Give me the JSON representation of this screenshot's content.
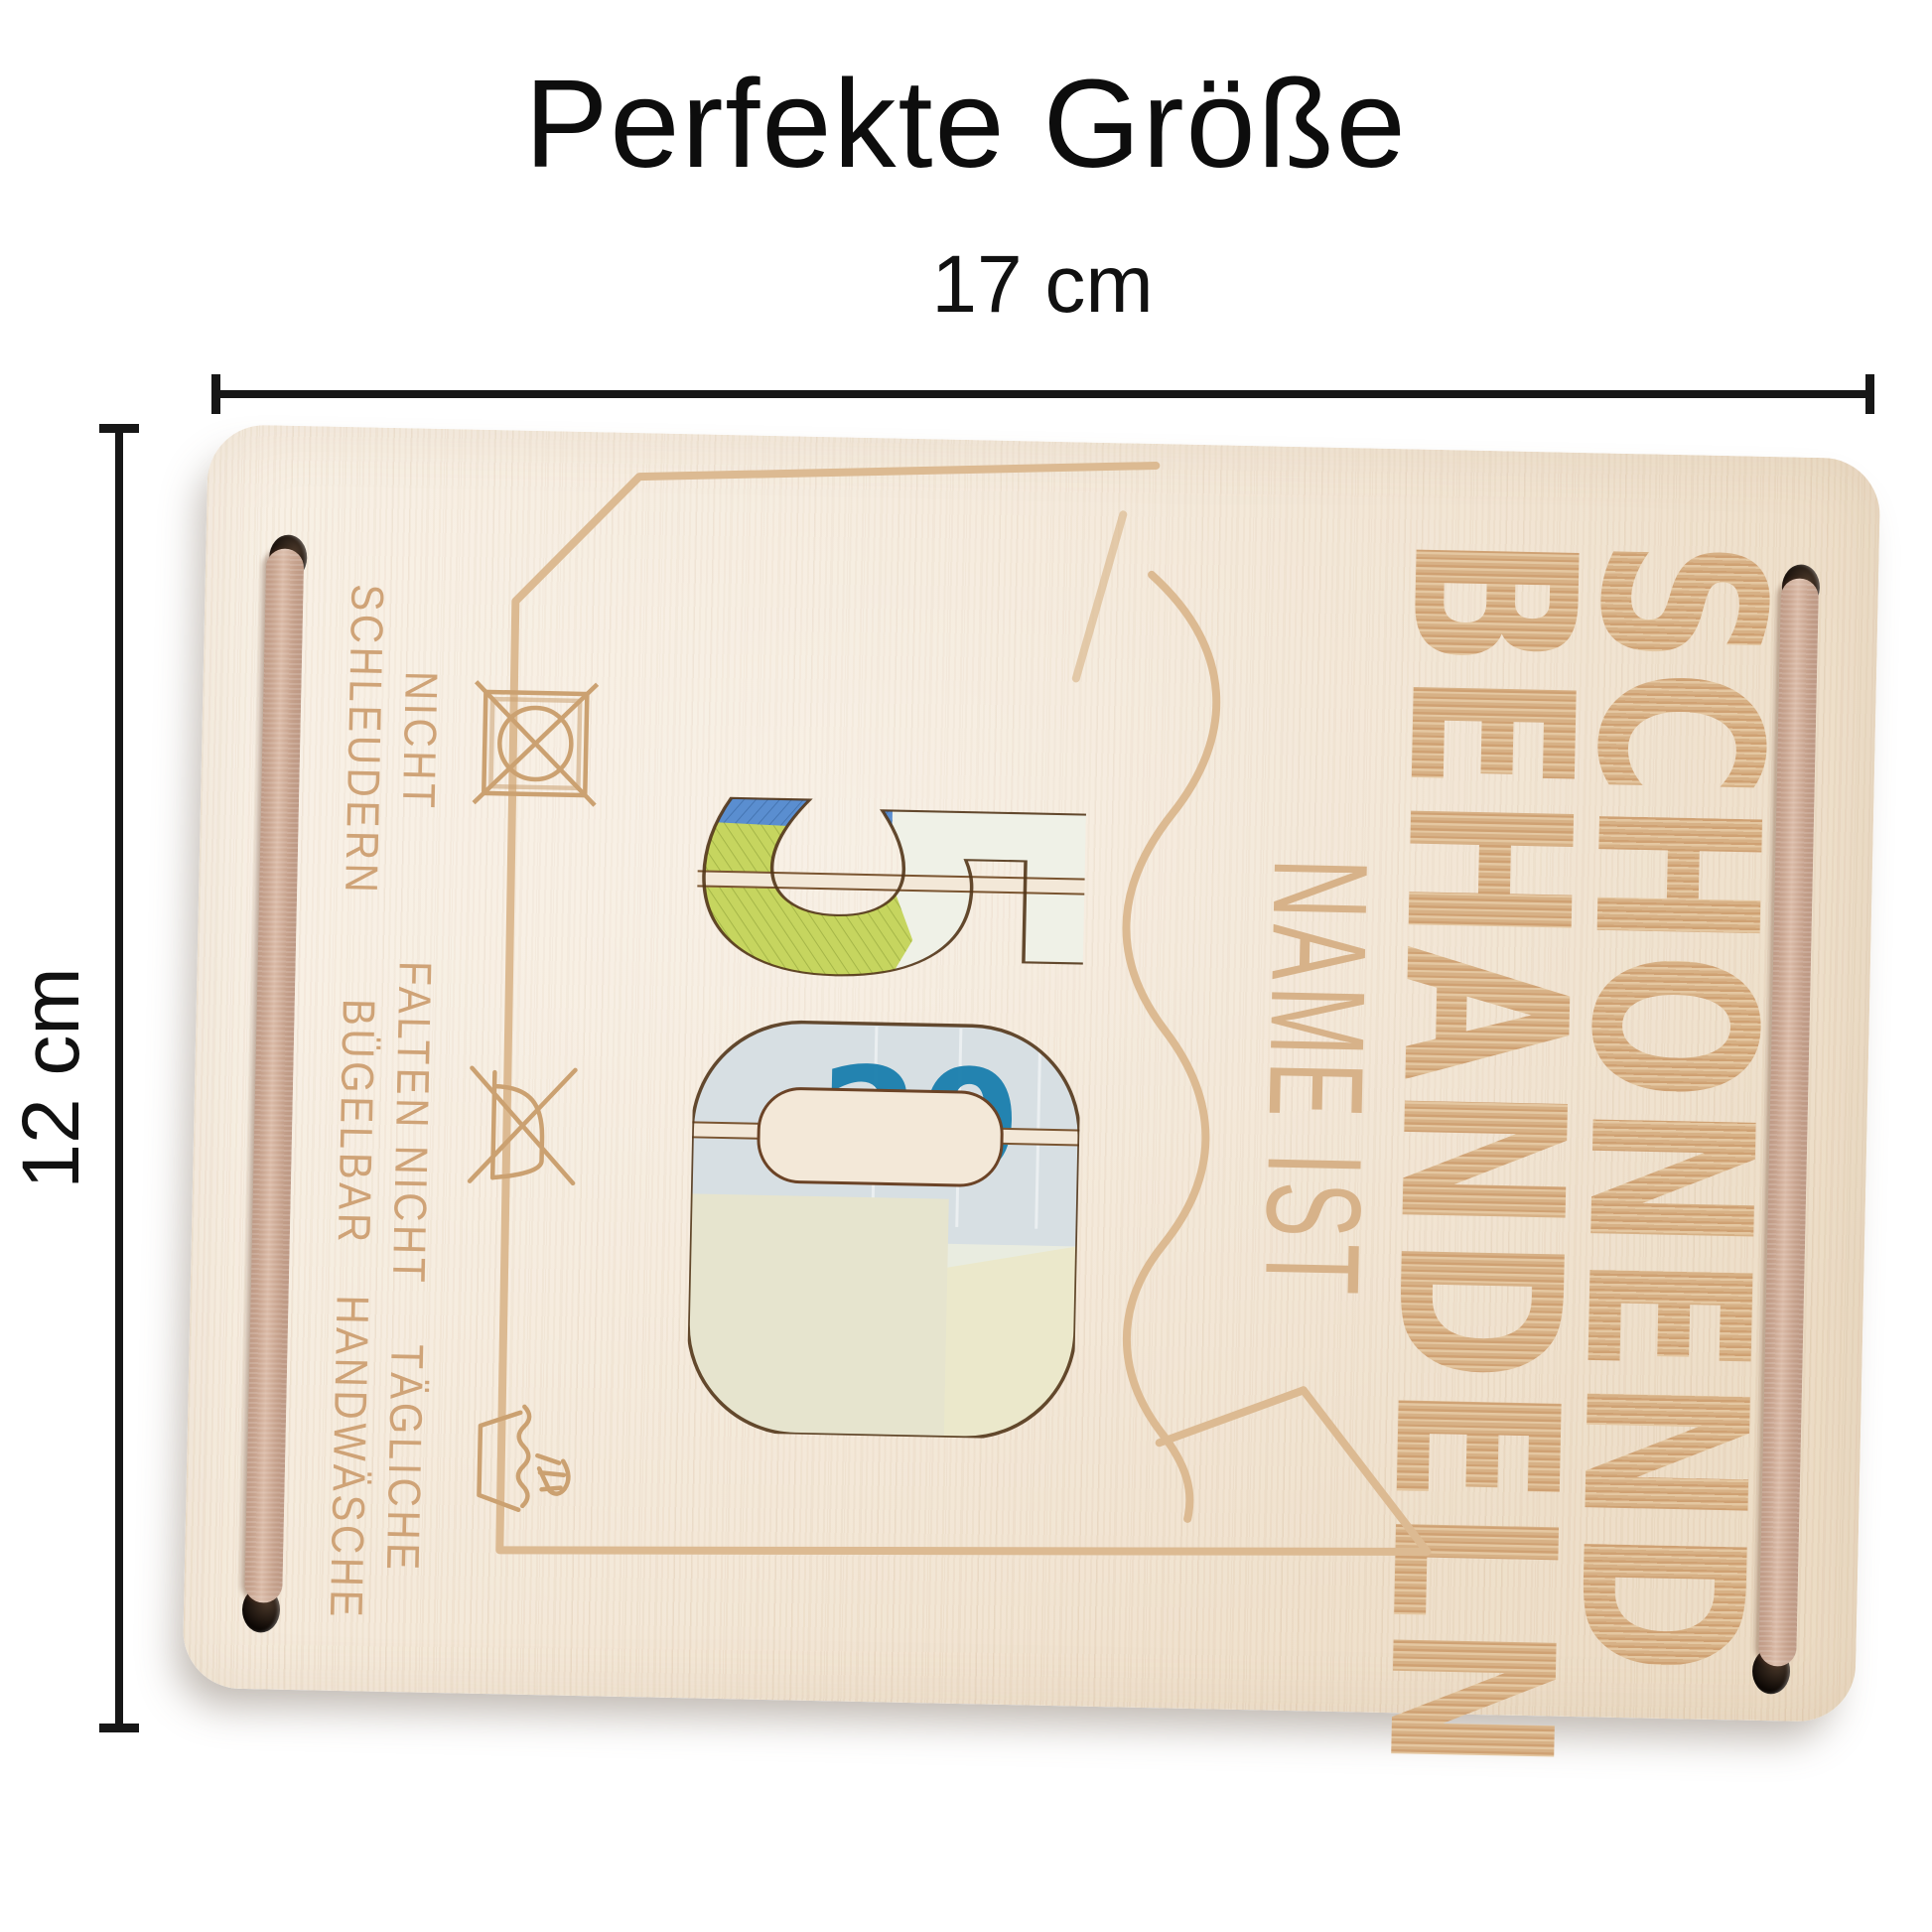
{
  "title": "Perfekte Größe",
  "dimensions": {
    "width_label": "17 cm",
    "height_label": "12 cm"
  },
  "card": {
    "headline_line1": "SCHONEND",
    "headline_line2": "BEHANDELN",
    "subline": "NAME IST",
    "amount": {
      "value": "50",
      "digit1": "5",
      "digit2": "0"
    },
    "banknote": {
      "value_text": "20",
      "serial_text": "RR04"
    },
    "care_instructions": [
      {
        "icon": "no-spin-icon",
        "line1": "NICHT",
        "line2": "SCHLEUDERN"
      },
      {
        "icon": "no-iron-icon",
        "line1": "FALTEN NICHT",
        "line2": "BÜGELBAR"
      },
      {
        "icon": "handwash-icon",
        "line1": "TÄGLICHE",
        "line2": "HANDWÄSCHE"
      }
    ],
    "colors": {
      "wood": "#f4e9da",
      "engraving": "#d9b68f",
      "engraving_small": "#cfa377",
      "cord": "#d2ab93",
      "hole": "#140d08",
      "note_teal": "#1a7fae",
      "note_blue": "#5a8ed0",
      "note_green": "#c6d55f",
      "dimension_line": "#171717"
    }
  }
}
